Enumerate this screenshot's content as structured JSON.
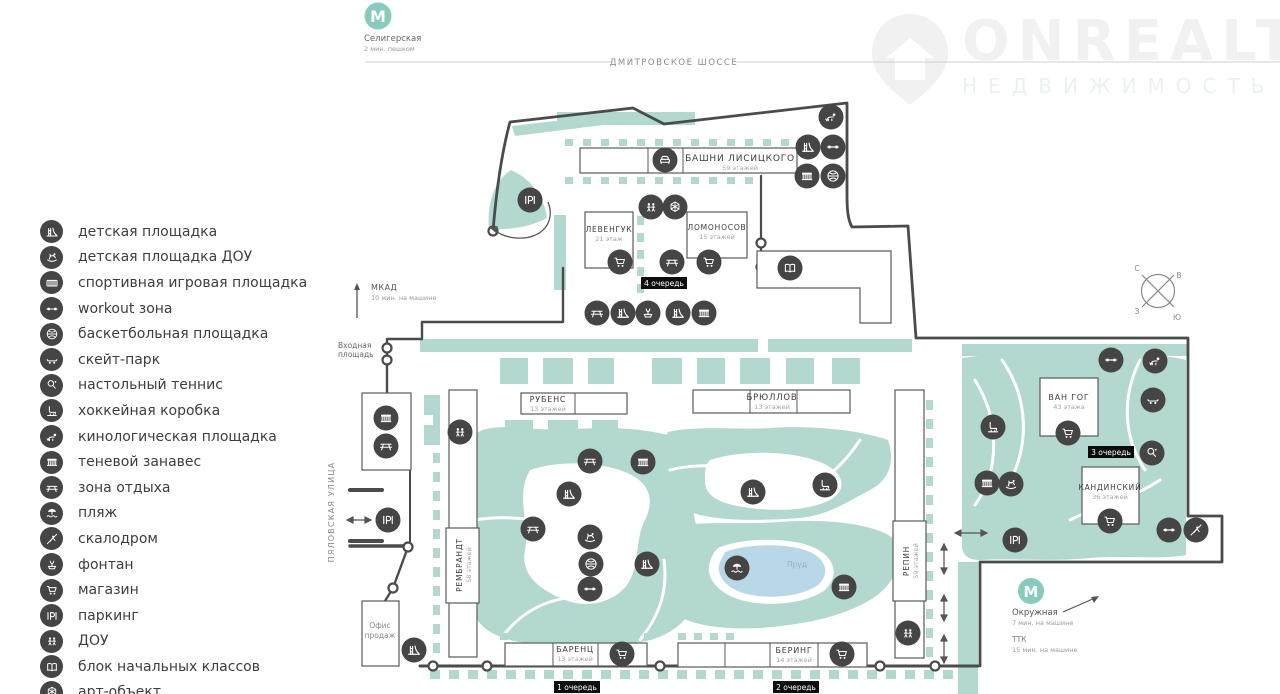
{
  "header": {
    "metro": {
      "name": "Селигерская",
      "note": "2 мин. пешком"
    },
    "highway": "ДМИТРОВСКОЕ ШОССЕ",
    "watermark": {
      "brand": "ONREALT",
      "sub": "НЕДВИЖИМОСТЬ"
    }
  },
  "legend": {
    "items": [
      {
        "icon": "playground",
        "label": "детская площадка"
      },
      {
        "icon": "horse",
        "label": "детская площадка ДОУ"
      },
      {
        "icon": "sportground",
        "label": "спортивная игровая площадка"
      },
      {
        "icon": "workout",
        "label": "workout зона"
      },
      {
        "icon": "basketball",
        "label": "баскетбольная площадка"
      },
      {
        "icon": "skate",
        "label": "скейт-парк"
      },
      {
        "icon": "tennis",
        "label": "настольный теннис"
      },
      {
        "icon": "hockey",
        "label": "хоккейная коробка"
      },
      {
        "icon": "dog",
        "label": "кинологическая площадка"
      },
      {
        "icon": "shade",
        "label": "теневой занавес"
      },
      {
        "icon": "rest",
        "label": "зона отдыха"
      },
      {
        "icon": "beach",
        "label": "пляж"
      },
      {
        "icon": "climb",
        "label": "скалодром"
      },
      {
        "icon": "fountain",
        "label": "фонтан"
      },
      {
        "icon": "shop",
        "label": "магазин"
      },
      {
        "icon": "parking",
        "label": "паркинг"
      },
      {
        "icon": "dou",
        "label": "ДОУ"
      },
      {
        "icon": "school",
        "label": "блок начальных классов"
      },
      {
        "icon": "art",
        "label": "арт-объект"
      }
    ]
  },
  "map": {
    "labels": {
      "mkad": {
        "title": "МКАД",
        "note": "10 мин. на машине"
      },
      "entrance_line1": "Входная",
      "entrance_line2": "площадь",
      "street": "ПЯЛОВСКАЯ УЛИЦА",
      "pond": "Пруд",
      "sales_office_line1": "Офис",
      "sales_office_line2": "продаж",
      "metro2": {
        "name": "Окружная",
        "note": "7 мин. на машине"
      },
      "ttk": {
        "title": "ТТК",
        "note": "15 мин. на машине"
      }
    },
    "compass": {
      "n": "С",
      "e": "В",
      "w": "З",
      "s": "Ю"
    },
    "phases": [
      {
        "label": "1 очередь",
        "cx": 577,
        "cy": 687
      },
      {
        "label": "2 очередь",
        "cx": 796,
        "cy": 687
      },
      {
        "label": "3 очередь",
        "cx": 1111,
        "cy": 452
      },
      {
        "label": "4 очередь",
        "cx": 664,
        "cy": 283
      }
    ],
    "buildings": [
      {
        "id": "bashni",
        "name": "БАШНИ ЛИСИЦКОГО",
        "floors": "59 этажей",
        "x": 580,
        "y": 148,
        "w": 217,
        "h": 25,
        "div": [
          648,
          683
        ],
        "tx": 740,
        "ty": 161,
        "fs": 9
      },
      {
        "id": "levenguk",
        "name": "ЛЕВЕНГУК",
        "floors": "21 этаж",
        "x": 585,
        "y": 212,
        "w": 48,
        "h": 56,
        "div": [],
        "tx": 609,
        "ty": 232,
        "fs": 7.5
      },
      {
        "id": "lomonosov",
        "name": "ЛОМОНОСОВ",
        "floors": "15 этажей",
        "x": 687,
        "y": 212,
        "w": 60,
        "h": 46,
        "div": [],
        "tx": 717,
        "ty": 230,
        "fs": 7.5
      },
      {
        "id": "rubens",
        "name": "РУБЕНС",
        "floors": "13 этажей",
        "x": 521,
        "y": 393,
        "w": 106,
        "h": 21,
        "div": [
          575
        ],
        "tx": 548,
        "ty": 402,
        "fs": 8
      },
      {
        "id": "bryullov",
        "name": "БРЮЛЛОВ",
        "floors": "13 этажей",
        "x": 693,
        "y": 390,
        "w": 157,
        "h": 23,
        "div": [
          750,
          797
        ],
        "tx": 772,
        "ty": 400,
        "fs": 8.5
      },
      {
        "id": "vangog",
        "name": "ВАН ГОГ",
        "floors": "43 этажа",
        "x": 1040,
        "y": 378,
        "w": 58,
        "h": 58,
        "div": [],
        "tx": 1069,
        "ty": 400,
        "fs": 8
      },
      {
        "id": "kandinsky",
        "name": "КАНДИНСКИЙ",
        "floors": "36 этажей",
        "x": 1082,
        "y": 467,
        "w": 57,
        "h": 57,
        "div": [],
        "tx": 1110,
        "ty": 490,
        "fs": 7.5
      },
      {
        "id": "rembrandt",
        "name": "РЕМБРАНДТ",
        "floors": "58 этажей",
        "x": 446,
        "y": 528,
        "w": 33,
        "h": 75,
        "div": [],
        "tx": 462,
        "ty": 565,
        "fs": 7.5,
        "vertical": true
      },
      {
        "id": "repin",
        "name": "РЕПИН",
        "floors": "59 этажей",
        "x": 893,
        "y": 521,
        "w": 33,
        "h": 80,
        "div": [],
        "tx": 909,
        "ty": 561,
        "fs": 7.5,
        "vertical": true
      },
      {
        "id": "barenc",
        "name": "БАРЕНЦ",
        "floors": "13 этажей",
        "x": 505,
        "y": 643,
        "w": 142,
        "h": 23,
        "div": [
          553,
          598
        ],
        "tx": 575,
        "ty": 652,
        "fs": 8
      },
      {
        "id": "bering",
        "name": "БЕРИНГ",
        "floors": "14 этажей",
        "x": 678,
        "y": 643,
        "w": 189,
        "h": 24,
        "div": [
          725,
          770,
          818
        ],
        "tx": 794,
        "ty": 653,
        "fs": 8
      }
    ],
    "icons": [
      {
        "type": "dog",
        "x": 831,
        "y": 117
      },
      {
        "type": "playground",
        "x": 808,
        "y": 147
      },
      {
        "type": "workout",
        "x": 833,
        "y": 147
      },
      {
        "type": "shade",
        "x": 807,
        "y": 176
      },
      {
        "type": "basketball",
        "x": 833,
        "y": 176
      },
      {
        "type": "lounge",
        "x": 665,
        "y": 160
      },
      {
        "type": "dou",
        "x": 651,
        "y": 207
      },
      {
        "type": "art",
        "x": 675,
        "y": 207
      },
      {
        "type": "shop",
        "x": 620,
        "y": 262
      },
      {
        "type": "rest",
        "x": 672,
        "y": 262
      },
      {
        "type": "shop",
        "x": 709,
        "y": 262
      },
      {
        "type": "school",
        "x": 790,
        "y": 268
      },
      {
        "type": "rest",
        "x": 597,
        "y": 313
      },
      {
        "type": "playground",
        "x": 623,
        "y": 313
      },
      {
        "type": "fountain",
        "x": 648,
        "y": 313
      },
      {
        "type": "playground",
        "x": 678,
        "y": 313
      },
      {
        "type": "shade",
        "x": 704,
        "y": 313
      },
      {
        "type": "parking",
        "x": 530,
        "y": 200
      },
      {
        "type": "shade",
        "x": 386,
        "y": 418
      },
      {
        "type": "rest",
        "x": 386,
        "y": 446
      },
      {
        "type": "dou",
        "x": 460,
        "y": 432
      },
      {
        "type": "parking",
        "x": 388,
        "y": 520
      },
      {
        "type": "rest",
        "x": 590,
        "y": 461
      },
      {
        "type": "shade",
        "x": 643,
        "y": 462
      },
      {
        "type": "playground",
        "x": 569,
        "y": 494
      },
      {
        "type": "rest",
        "x": 533,
        "y": 529
      },
      {
        "type": "horse",
        "x": 590,
        "y": 537
      },
      {
        "type": "basketball",
        "x": 591,
        "y": 564
      },
      {
        "type": "playground",
        "x": 647,
        "y": 564
      },
      {
        "type": "workout",
        "x": 590,
        "y": 589
      },
      {
        "type": "playground",
        "x": 753,
        "y": 492
      },
      {
        "type": "hockey",
        "x": 825,
        "y": 485
      },
      {
        "type": "beach",
        "x": 737,
        "y": 568
      },
      {
        "type": "shade",
        "x": 844,
        "y": 587
      },
      {
        "type": "workout",
        "x": 1111,
        "y": 360
      },
      {
        "type": "dog",
        "x": 1155,
        "y": 361
      },
      {
        "type": "skate",
        "x": 1153,
        "y": 400
      },
      {
        "type": "hockey",
        "x": 993,
        "y": 427
      },
      {
        "type": "shop",
        "x": 1068,
        "y": 433
      },
      {
        "type": "tennis",
        "x": 1152,
        "y": 453
      },
      {
        "type": "shade",
        "x": 987,
        "y": 483
      },
      {
        "type": "horse",
        "x": 1011,
        "y": 484
      },
      {
        "type": "shop",
        "x": 1110,
        "y": 521
      },
      {
        "type": "workout",
        "x": 1169,
        "y": 530
      },
      {
        "type": "climb",
        "x": 1196,
        "y": 530
      },
      {
        "type": "parking",
        "x": 1015,
        "y": 540
      },
      {
        "type": "dou",
        "x": 908,
        "y": 633
      },
      {
        "type": "playground",
        "x": 414,
        "y": 650
      },
      {
        "type": "shop",
        "x": 622,
        "y": 654
      },
      {
        "type": "shop",
        "x": 842,
        "y": 654
      }
    ]
  }
}
